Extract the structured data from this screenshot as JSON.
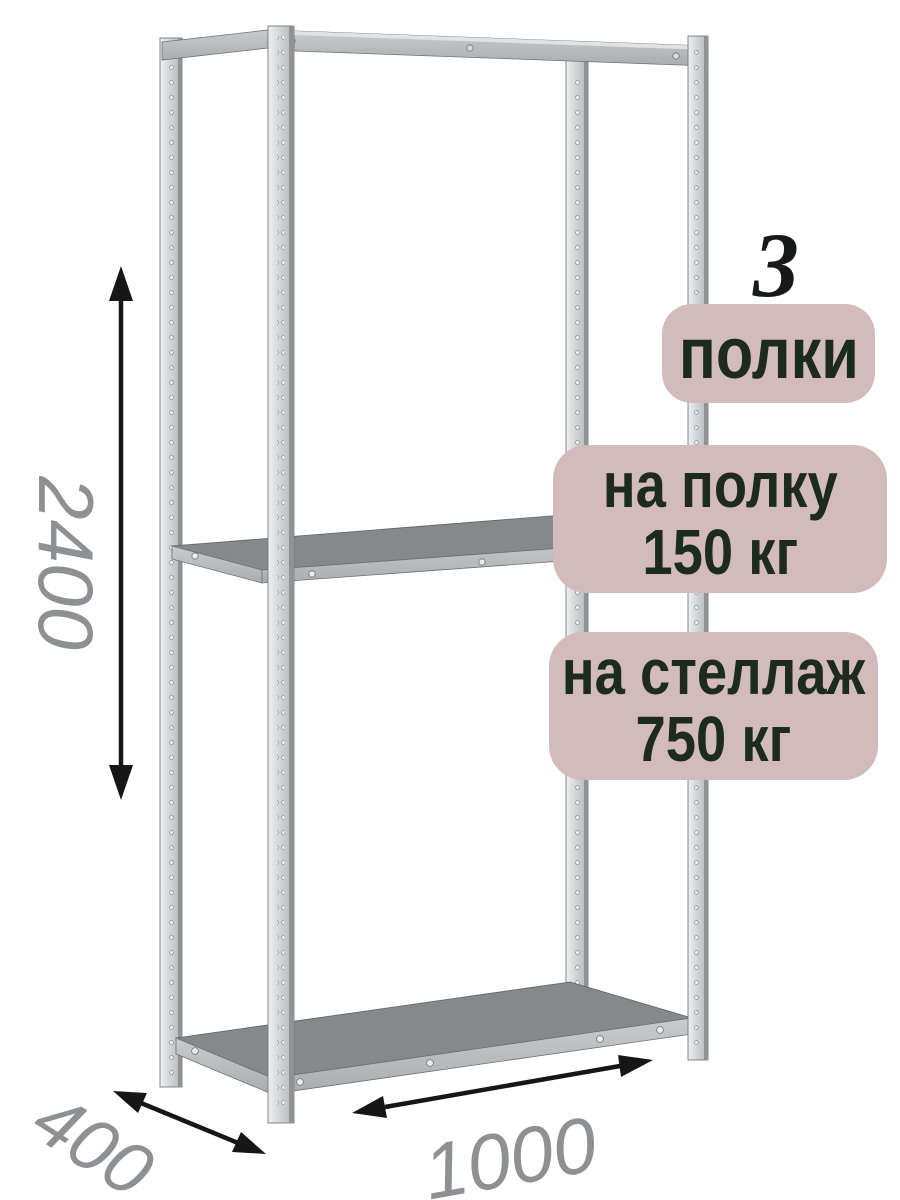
{
  "colors": {
    "background": "#ffffff",
    "badge_bg": "#d3bbbc",
    "badge_text": "#1d2b1f",
    "count_text": "#151a16",
    "dimension_text": "#8d9194",
    "arrow": "#161616",
    "metal_light": "#eef0f1",
    "metal_mid": "#d2d5d7",
    "metal_shade": "#8f9396",
    "shelf_surface": "#85898c",
    "shelf_edge_band": "#bbbec0"
  },
  "callouts": {
    "shelf_count": {
      "value": "3",
      "label": "полки"
    },
    "per_shelf": {
      "line1": "на полку",
      "line2": "150 кг"
    },
    "per_rack": {
      "line1": "на стеллаж",
      "line2": "750 кг"
    }
  },
  "dimensions": {
    "height": "2400",
    "depth": "400",
    "width": "1000"
  }
}
